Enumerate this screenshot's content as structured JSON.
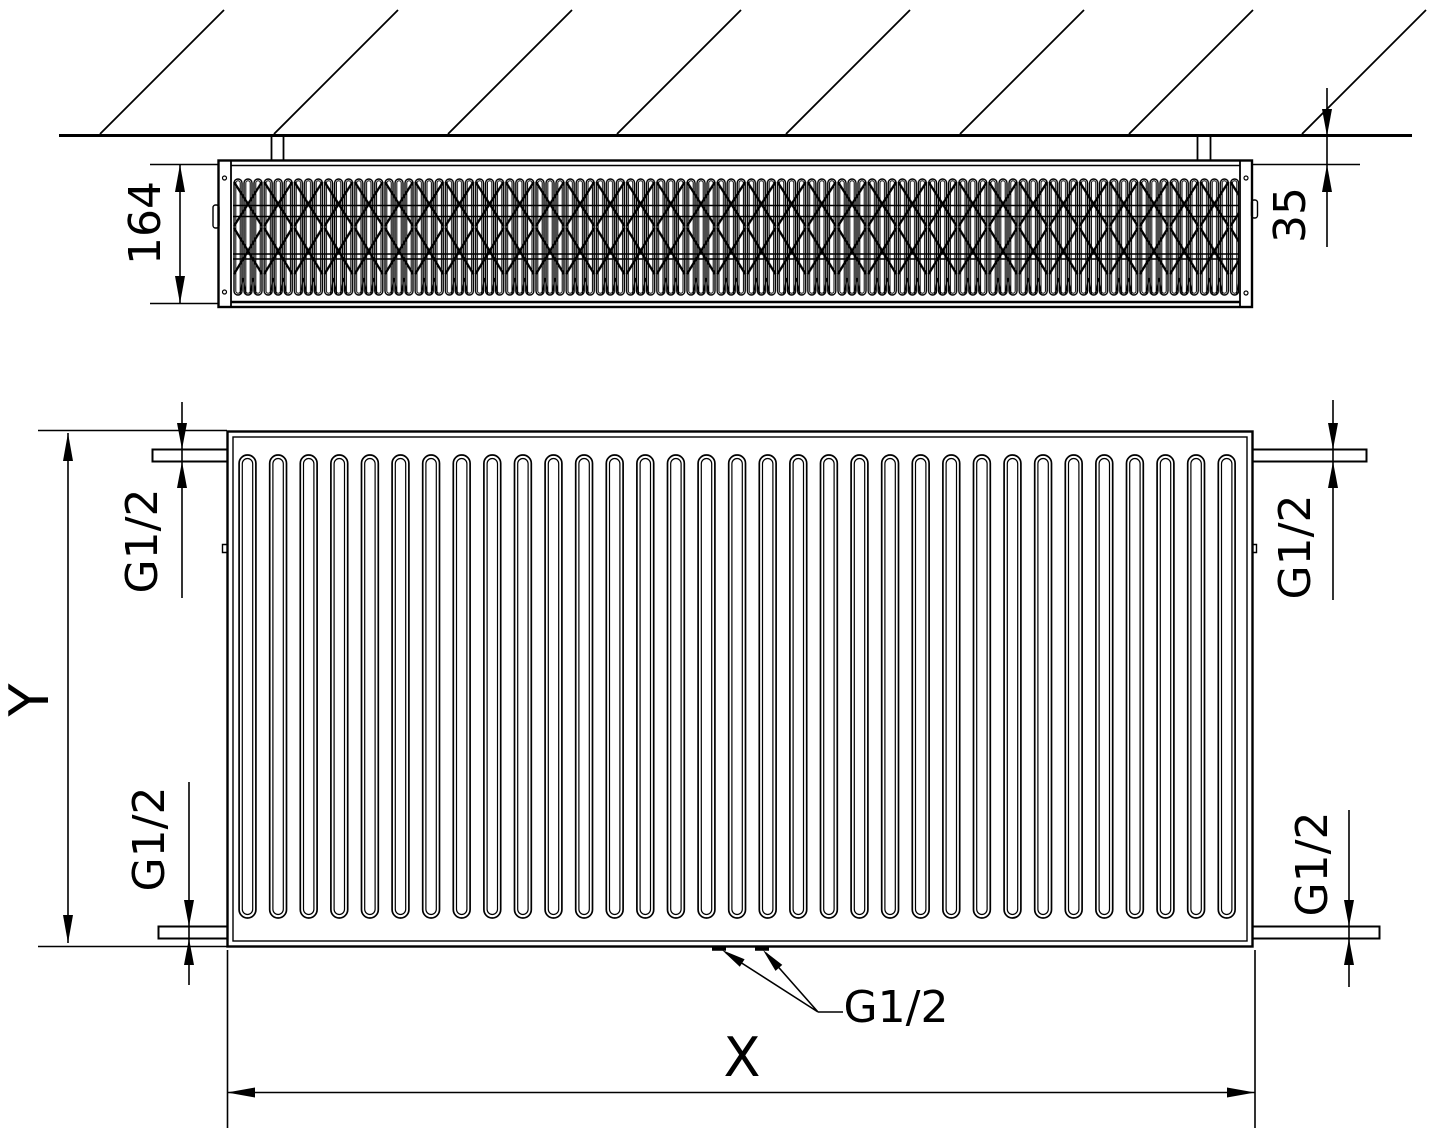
{
  "drawing_type": "radiator technical drawing, two orthographic views",
  "colors": {
    "line": "#000000",
    "background": "#ffffff",
    "text": "#000000"
  },
  "top_view": {
    "description": "horizontal section at wall with convector fins",
    "depth_dim_label": "164",
    "wall_distance_dim_label": "35"
  },
  "front_view": {
    "description": "front elevation with vertical panel channels",
    "height_dim_label": "Y",
    "width_dim_label": "X",
    "channel_count": 33,
    "channel_start_x": 247.5,
    "channel_pitch": 30.6,
    "connections": {
      "top_left_label": "G1/2",
      "top_right_label": "G1/2",
      "bottom_left_label": "G1/2",
      "bottom_right_label": "G1/2",
      "bottom_center_label": "G1/2"
    }
  }
}
